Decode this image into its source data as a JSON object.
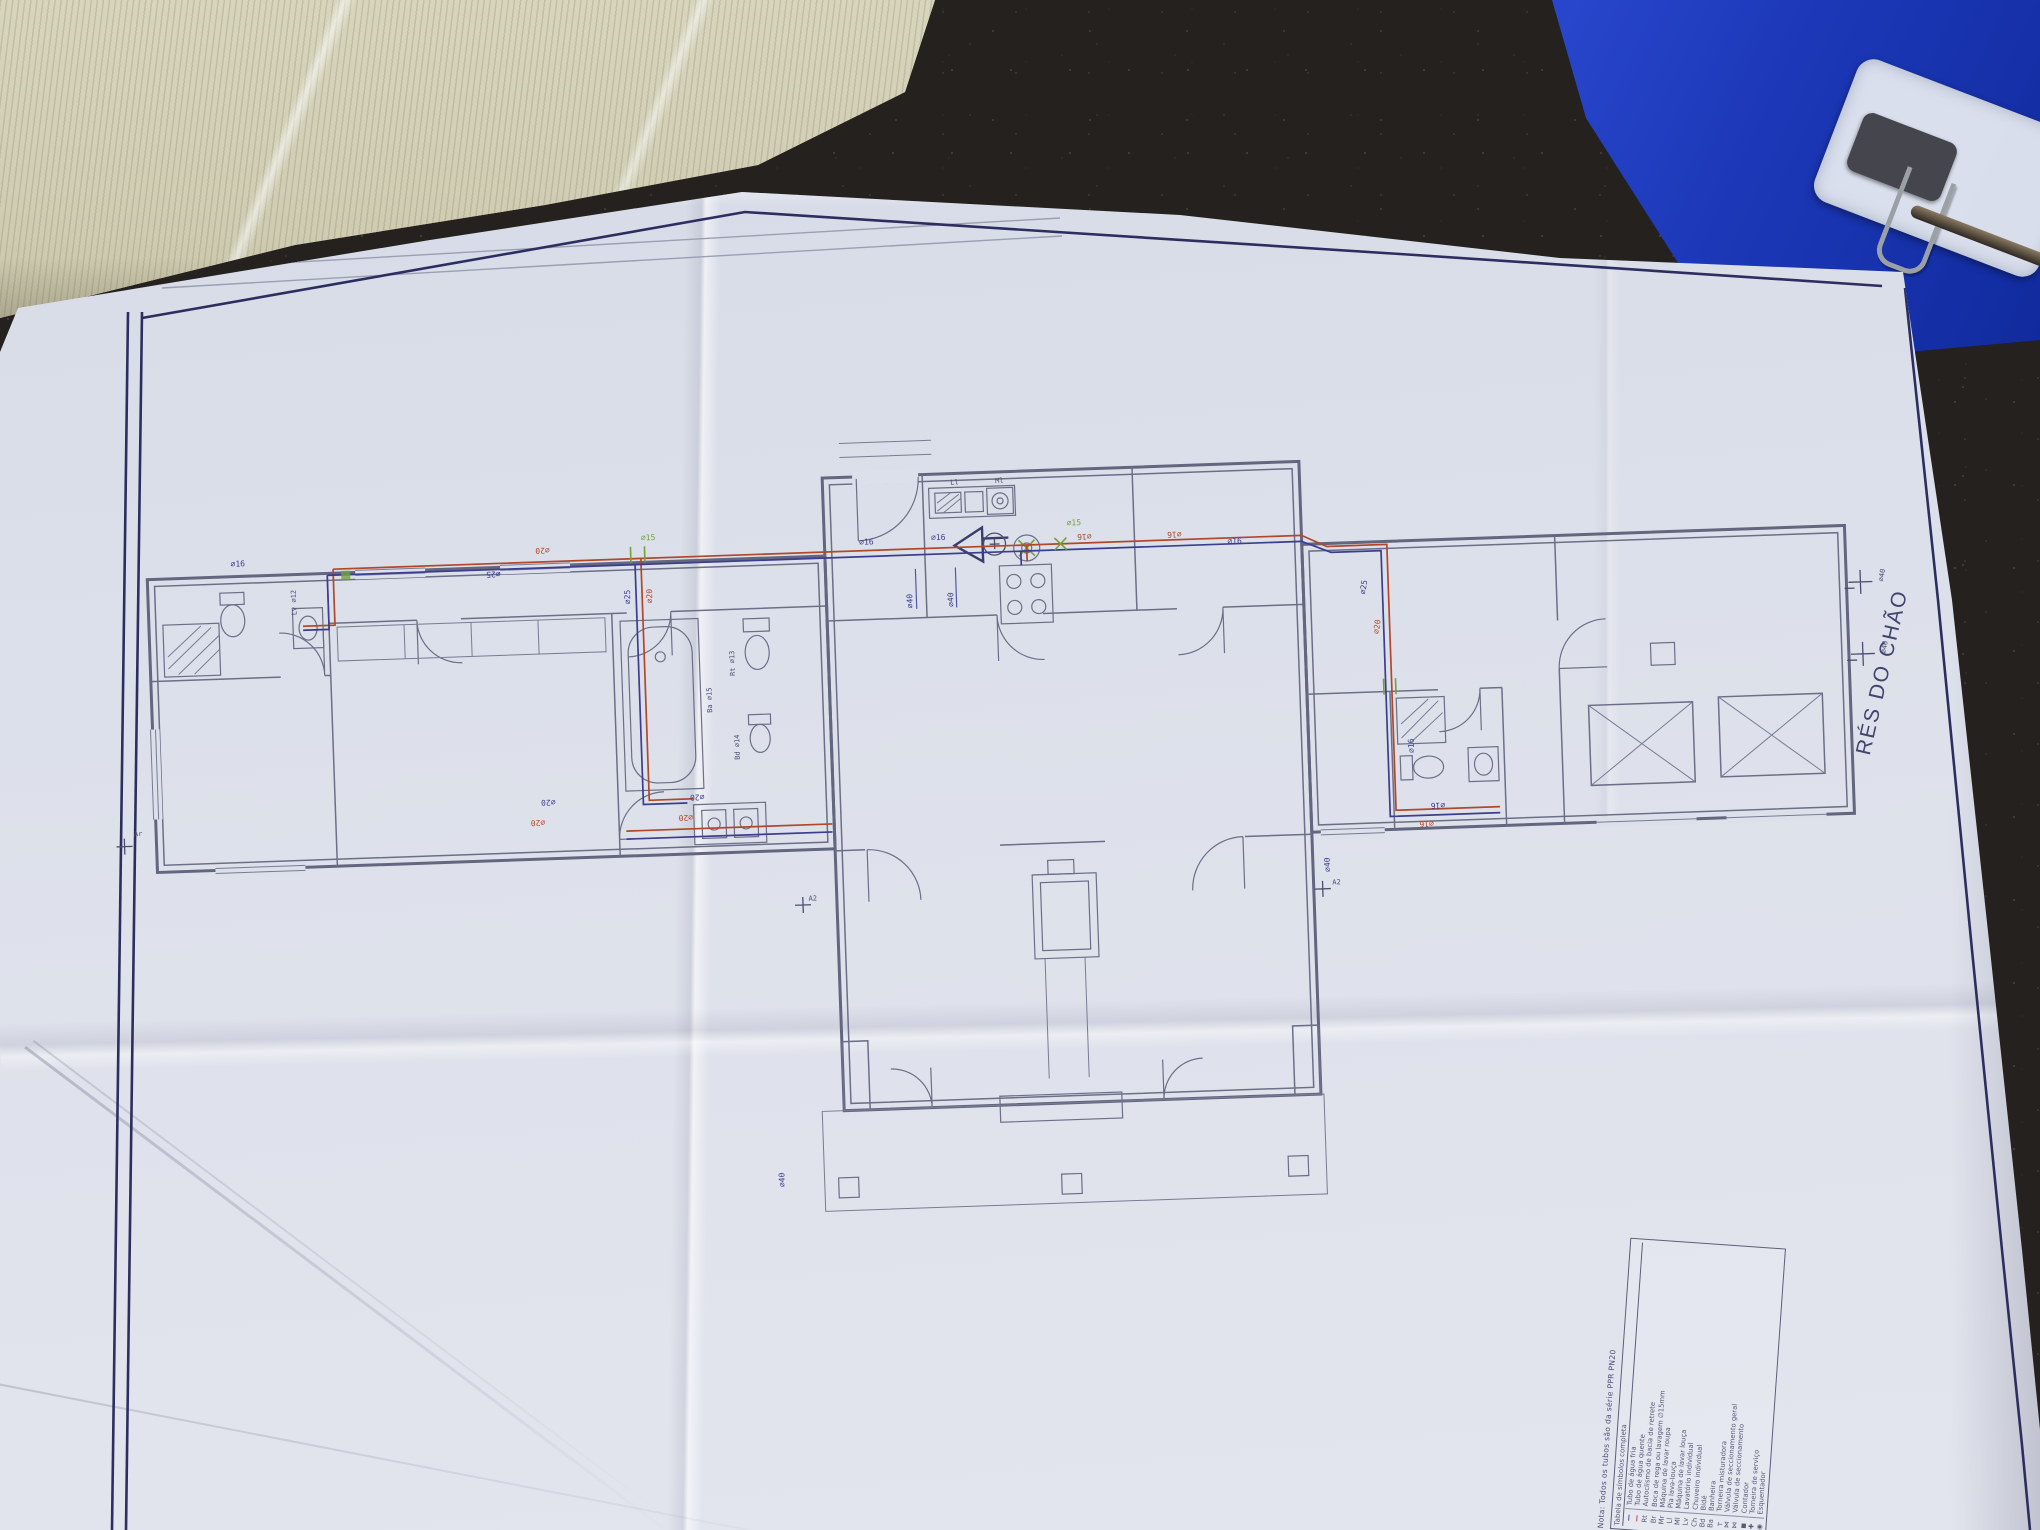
{
  "colors": {
    "floor_dark": "#24211e",
    "cardboard": "#d3d0b8",
    "folder_blue": "#1c38b8",
    "paper": "#dce0ea",
    "ink_wall": "#62667f",
    "ink_border": "#2d2e60",
    "pipe_hot": "#b2482a",
    "pipe_cold": "#3c3d8f",
    "ink_green": "#76a03c"
  },
  "plan": {
    "title": "RÉS DO CHÃO",
    "labels": [
      "∅20",
      "∅25",
      "∅16",
      "∅15",
      "∅25",
      "∅20",
      "∅20",
      "∅20",
      "∅20",
      "∅20",
      "Ba ∅15",
      "Rt ∅13",
      "Bd ∅14",
      "∅16",
      "∅16",
      "∅16",
      "∅15",
      "∅40",
      "∅40",
      "Ml",
      "Ll",
      "∅16",
      "∅16",
      "∅25",
      "∅20",
      "∅16",
      "∅16",
      "∅16",
      "∅40",
      "A2",
      "A2",
      "∅40",
      "∅40",
      "∅40",
      "Ar",
      "Lv ∅12"
    ]
  },
  "legend": {
    "note": "Nota: Todos os tubos são da série PPR PN20",
    "header": "Tabela de símbolos completa",
    "rows": [
      {
        "sym": "—",
        "label": "Tubo de água fria"
      },
      {
        "sym": "—",
        "label": "Tubo de água quente"
      },
      {
        "sym": "Rt",
        "label": "Autoclismo de bacia de retrete"
      },
      {
        "sym": "Br",
        "label": "Boca de rega ou lavagem ∅15mm"
      },
      {
        "sym": "Mr",
        "label": "Máquina de lavar roupa"
      },
      {
        "sym": "Ll",
        "label": "Pia lava-louça"
      },
      {
        "sym": "Ml",
        "label": "Máquina de lavar louça"
      },
      {
        "sym": "Lv",
        "label": "Lavatório individual"
      },
      {
        "sym": "Ch",
        "label": "Chuveiro individual"
      },
      {
        "sym": "Bd",
        "label": "Bidé"
      },
      {
        "sym": "Ba",
        "label": "Banheira"
      },
      {
        "sym": "┬",
        "label": "Torneira misturadora"
      },
      {
        "sym": "⋈",
        "label": "Válvula de seccionamento geral"
      },
      {
        "sym": "⋈",
        "label": "Válvula de seccionamento"
      },
      {
        "sym": "◼",
        "label": "Contador"
      },
      {
        "sym": "✚",
        "label": "Torneira de serviço"
      },
      {
        "sym": "◉",
        "label": "Esquentador"
      }
    ]
  }
}
